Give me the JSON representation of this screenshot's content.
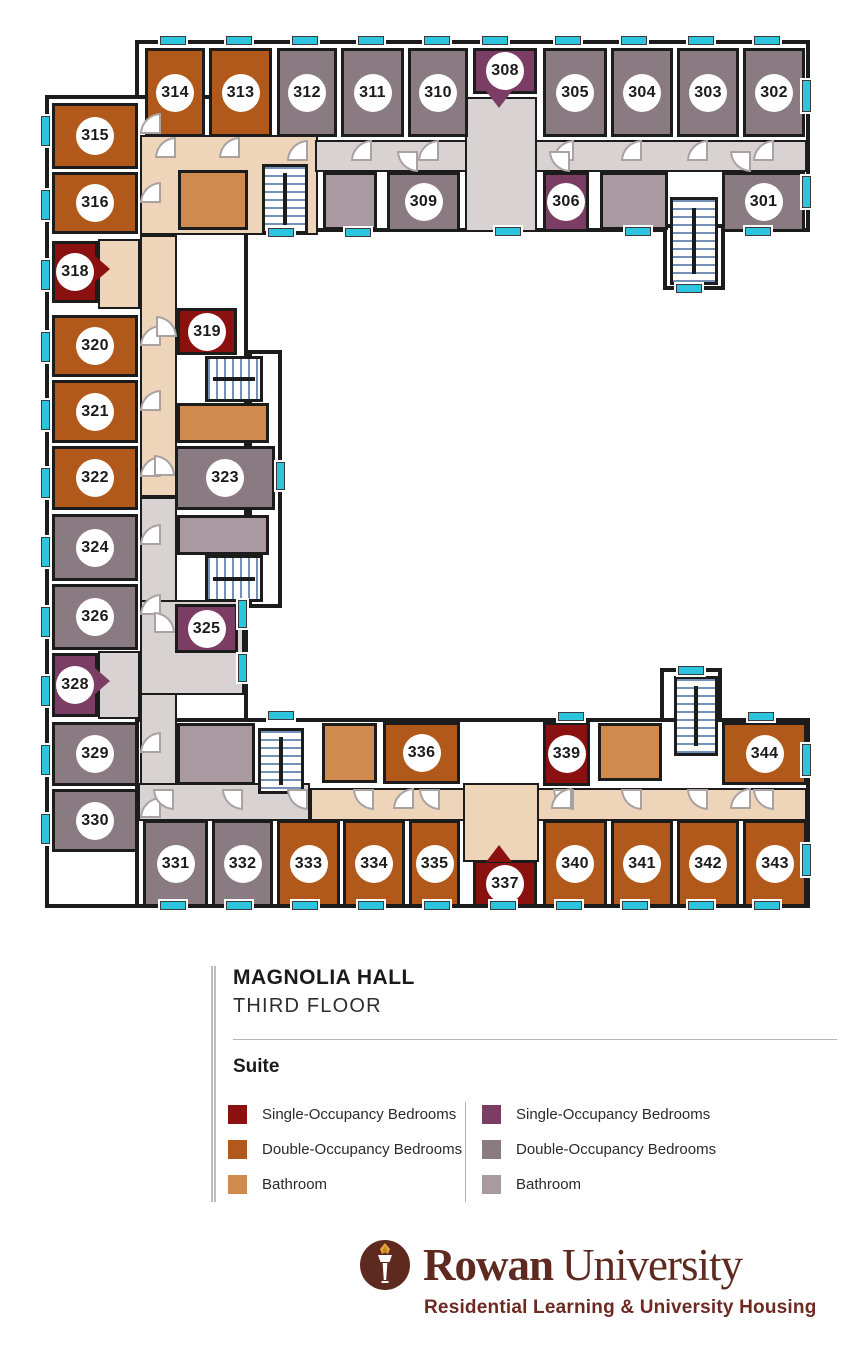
{
  "header": {
    "building": "MAGNOLIA HALL",
    "floor": "THIRD FLOOR"
  },
  "legend": {
    "heading": "Suite",
    "columns": [
      {
        "items": [
          {
            "swatch": "A.single",
            "label": "Single-Occupancy Bedrooms"
          },
          {
            "swatch": "A.double",
            "label": "Double-Occupancy Bedrooms"
          },
          {
            "swatch": "A.bath",
            "label": "Bathroom"
          }
        ]
      },
      {
        "items": [
          {
            "swatch": "B.single",
            "label": "Single-Occupancy Bedrooms"
          },
          {
            "swatch": "B.double",
            "label": "Double-Occupancy Bedrooms"
          },
          {
            "swatch": "B.bath",
            "label": "Bathroom"
          }
        ]
      }
    ]
  },
  "footer": {
    "brand_primary": "Rowan",
    "brand_secondary": "University",
    "tagline": "Residential Learning & University Housing"
  },
  "palette": {
    "suites": {
      "A": {
        "single": "#8b1010",
        "double": "#b1591a",
        "bath": "#d08a4e",
        "hall": "#eed5ba"
      },
      "B": {
        "single": "#7b3d64",
        "double": "#8a7a81",
        "bath": "#a89aa0",
        "hall": "#d8d3d2"
      }
    },
    "window": "#2cc4de",
    "wall": "#1c1c1c",
    "stair_tread": "#7492b8",
    "logo_brown": "#5e2a20",
    "tagline_brown": "#6e2a22",
    "flame_gold": "#e8a33c"
  },
  "floorplan": {
    "shell": [
      {
        "x": 135,
        "y": 40,
        "w": 675,
        "h": 192
      },
      {
        "x": 45,
        "y": 95,
        "w": 203,
        "h": 813
      },
      {
        "x": 248,
        "y": 350,
        "w": 34,
        "h": 258
      },
      {
        "x": 135,
        "y": 718,
        "w": 675,
        "h": 190
      },
      {
        "x": 663,
        "y": 224,
        "w": 62,
        "h": 66
      },
      {
        "x": 660,
        "y": 668,
        "w": 62,
        "h": 54
      }
    ],
    "corridors": [
      {
        "x": 140,
        "y": 135,
        "w": 178,
        "h": 100,
        "fill": "A.hall"
      },
      {
        "x": 140,
        "y": 235,
        "w": 37,
        "h": 262,
        "fill": "A.hall"
      },
      {
        "x": 98,
        "y": 239,
        "w": 42,
        "h": 70,
        "fill": "A.hall"
      },
      {
        "x": 310,
        "y": 788,
        "w": 497,
        "h": 33,
        "fill": "A.hall"
      },
      {
        "x": 463,
        "y": 783,
        "w": 76,
        "h": 79,
        "fill": "A.hall"
      },
      {
        "x": 315,
        "y": 140,
        "w": 492,
        "h": 32,
        "fill": "B.hall"
      },
      {
        "x": 465,
        "y": 97,
        "w": 72,
        "h": 135,
        "fill": "B.hall"
      },
      {
        "x": 140,
        "y": 497,
        "w": 37,
        "h": 291,
        "fill": "B.hall"
      },
      {
        "x": 98,
        "y": 651,
        "w": 42,
        "h": 68,
        "fill": "B.hall"
      },
      {
        "x": 140,
        "y": 600,
        "w": 104,
        "h": 95,
        "fill": "B.hall"
      },
      {
        "x": 138,
        "y": 783,
        "w": 172,
        "h": 38,
        "fill": "B.hall"
      }
    ],
    "baths": [
      {
        "x": 178,
        "y": 170,
        "w": 70,
        "h": 60,
        "fill": "A.bath"
      },
      {
        "x": 323,
        "y": 172,
        "w": 54,
        "h": 58,
        "fill": "B.bath"
      },
      {
        "x": 600,
        "y": 172,
        "w": 68,
        "h": 58,
        "fill": "B.bath"
      },
      {
        "x": 177,
        "y": 403,
        "w": 92,
        "h": 40,
        "fill": "A.bath"
      },
      {
        "x": 177,
        "y": 515,
        "w": 92,
        "h": 40,
        "fill": "B.bath"
      },
      {
        "x": 177,
        "y": 723,
        "w": 78,
        "h": 62,
        "fill": "B.bath"
      },
      {
        "x": 322,
        "y": 723,
        "w": 55,
        "h": 60,
        "fill": "A.bath"
      },
      {
        "x": 598,
        "y": 723,
        "w": 64,
        "h": 58,
        "fill": "A.bath"
      }
    ],
    "stairs": [
      {
        "x": 262,
        "y": 164,
        "w": 46,
        "h": 70,
        "dir": "v"
      },
      {
        "x": 670,
        "y": 197,
        "w": 48,
        "h": 88,
        "dir": "v"
      },
      {
        "x": 205,
        "y": 356,
        "w": 58,
        "h": 46,
        "dir": "h"
      },
      {
        "x": 205,
        "y": 555,
        "w": 58,
        "h": 47,
        "dir": "h"
      },
      {
        "x": 258,
        "y": 728,
        "w": 46,
        "h": 66,
        "dir": "v"
      },
      {
        "x": 674,
        "y": 676,
        "w": 44,
        "h": 80,
        "dir": "v"
      }
    ],
    "rooms": [
      {
        "num": "314",
        "x": 145,
        "y": 48,
        "w": 60,
        "h": 89,
        "fill": "A.double"
      },
      {
        "num": "313",
        "x": 209,
        "y": 48,
        "w": 63,
        "h": 89,
        "fill": "A.double"
      },
      {
        "num": "312",
        "x": 277,
        "y": 48,
        "w": 60,
        "h": 89,
        "fill": "B.double"
      },
      {
        "num": "311",
        "x": 341,
        "y": 48,
        "w": 63,
        "h": 89,
        "fill": "B.double"
      },
      {
        "num": "310",
        "x": 408,
        "y": 48,
        "w": 60,
        "h": 89,
        "fill": "B.double"
      },
      {
        "num": "308",
        "x": 473,
        "y": 48,
        "w": 64,
        "h": 46,
        "fill": "B.single"
      },
      {
        "num": "305",
        "x": 543,
        "y": 48,
        "w": 64,
        "h": 89,
        "fill": "B.double"
      },
      {
        "num": "304",
        "x": 611,
        "y": 48,
        "w": 62,
        "h": 89,
        "fill": "B.double"
      },
      {
        "num": "303",
        "x": 677,
        "y": 48,
        "w": 62,
        "h": 89,
        "fill": "B.double"
      },
      {
        "num": "302",
        "x": 743,
        "y": 48,
        "w": 62,
        "h": 89,
        "fill": "B.double"
      },
      {
        "num": "315",
        "x": 52,
        "y": 103,
        "w": 86,
        "h": 66,
        "fill": "A.double"
      },
      {
        "num": "316",
        "x": 52,
        "y": 172,
        "w": 86,
        "h": 62,
        "fill": "A.double"
      },
      {
        "num": "309",
        "x": 387,
        "y": 172,
        "w": 73,
        "h": 60,
        "fill": "B.double"
      },
      {
        "num": "306",
        "x": 543,
        "y": 172,
        "w": 46,
        "h": 60,
        "fill": "B.single"
      },
      {
        "num": "301",
        "x": 722,
        "y": 172,
        "w": 83,
        "h": 60,
        "fill": "B.double"
      },
      {
        "num": "318",
        "x": 52,
        "y": 241,
        "w": 46,
        "h": 62,
        "fill": "A.single"
      },
      {
        "num": "319",
        "x": 177,
        "y": 308,
        "w": 60,
        "h": 47,
        "fill": "A.single"
      },
      {
        "num": "320",
        "x": 52,
        "y": 315,
        "w": 86,
        "h": 62,
        "fill": "A.double"
      },
      {
        "num": "321",
        "x": 52,
        "y": 380,
        "w": 86,
        "h": 63,
        "fill": "A.double"
      },
      {
        "num": "322",
        "x": 52,
        "y": 446,
        "w": 86,
        "h": 64,
        "fill": "A.double"
      },
      {
        "num": "323",
        "x": 175,
        "y": 446,
        "w": 100,
        "h": 64,
        "fill": "B.double"
      },
      {
        "num": "324",
        "x": 52,
        "y": 514,
        "w": 86,
        "h": 67,
        "fill": "B.double"
      },
      {
        "num": "326",
        "x": 52,
        "y": 584,
        "w": 86,
        "h": 66,
        "fill": "B.double"
      },
      {
        "num": "325",
        "x": 175,
        "y": 604,
        "w": 63,
        "h": 49,
        "fill": "B.single"
      },
      {
        "num": "328",
        "x": 52,
        "y": 653,
        "w": 46,
        "h": 64,
        "fill": "B.single"
      },
      {
        "num": "329",
        "x": 52,
        "y": 722,
        "w": 86,
        "h": 64,
        "fill": "B.double"
      },
      {
        "num": "330",
        "x": 52,
        "y": 789,
        "w": 86,
        "h": 63,
        "fill": "B.double"
      },
      {
        "num": "336",
        "x": 383,
        "y": 722,
        "w": 77,
        "h": 62,
        "fill": "A.double"
      },
      {
        "num": "339",
        "x": 543,
        "y": 722,
        "w": 47,
        "h": 64,
        "fill": "A.single"
      },
      {
        "num": "344",
        "x": 722,
        "y": 722,
        "w": 85,
        "h": 63,
        "fill": "A.double"
      },
      {
        "num": "331",
        "x": 143,
        "y": 820,
        "w": 65,
        "h": 87,
        "fill": "B.double"
      },
      {
        "num": "332",
        "x": 212,
        "y": 820,
        "w": 61,
        "h": 87,
        "fill": "B.double"
      },
      {
        "num": "333",
        "x": 277,
        "y": 820,
        "w": 63,
        "h": 87,
        "fill": "A.double"
      },
      {
        "num": "334",
        "x": 343,
        "y": 820,
        "w": 62,
        "h": 87,
        "fill": "A.double"
      },
      {
        "num": "335",
        "x": 409,
        "y": 820,
        "w": 51,
        "h": 87,
        "fill": "A.double"
      },
      {
        "num": "337",
        "x": 473,
        "y": 860,
        "w": 64,
        "h": 47,
        "fill": "A.single"
      },
      {
        "num": "340",
        "x": 543,
        "y": 820,
        "w": 64,
        "h": 87,
        "fill": "A.double"
      },
      {
        "num": "341",
        "x": 611,
        "y": 820,
        "w": 62,
        "h": 87,
        "fill": "A.double"
      },
      {
        "num": "342",
        "x": 677,
        "y": 820,
        "w": 62,
        "h": 87,
        "fill": "A.double"
      },
      {
        "num": "343",
        "x": 743,
        "y": 820,
        "w": 64,
        "h": 87,
        "fill": "A.double"
      }
    ],
    "tails": [
      {
        "x": 486,
        "y": 91,
        "w": 26,
        "h": 17,
        "dir": "down",
        "fill": "B.single"
      },
      {
        "x": 95,
        "y": 256,
        "w": 15,
        "h": 26,
        "dir": "right",
        "fill": "A.single"
      },
      {
        "x": 95,
        "y": 668,
        "w": 15,
        "h": 26,
        "dir": "right",
        "fill": "B.single"
      },
      {
        "x": 486,
        "y": 845,
        "w": 26,
        "h": 17,
        "dir": "up",
        "fill": "A.single"
      }
    ],
    "doors": [
      {
        "x": 287,
        "y": 140,
        "q": "tl"
      },
      {
        "x": 351,
        "y": 140,
        "q": "tl"
      },
      {
        "x": 418,
        "y": 140,
        "q": "tl"
      },
      {
        "x": 553,
        "y": 140,
        "q": "tl"
      },
      {
        "x": 621,
        "y": 140,
        "q": "tl"
      },
      {
        "x": 687,
        "y": 140,
        "q": "tl"
      },
      {
        "x": 753,
        "y": 140,
        "q": "tl"
      },
      {
        "x": 155,
        "y": 137,
        "q": "tl"
      },
      {
        "x": 219,
        "y": 137,
        "q": "tl"
      },
      {
        "x": 397,
        "y": 151,
        "q": "bl"
      },
      {
        "x": 549,
        "y": 151,
        "q": "bl"
      },
      {
        "x": 730,
        "y": 151,
        "q": "bl"
      },
      {
        "x": 140,
        "y": 113,
        "q": "tl"
      },
      {
        "x": 140,
        "y": 182,
        "q": "tl"
      },
      {
        "x": 140,
        "y": 325,
        "q": "tl"
      },
      {
        "x": 140,
        "y": 390,
        "q": "tl"
      },
      {
        "x": 140,
        "y": 456,
        "q": "tl"
      },
      {
        "x": 140,
        "y": 524,
        "q": "tl"
      },
      {
        "x": 140,
        "y": 594,
        "q": "tl"
      },
      {
        "x": 140,
        "y": 732,
        "q": "tl"
      },
      {
        "x": 140,
        "y": 797,
        "q": "tl"
      },
      {
        "x": 156,
        "y": 316,
        "q": "tr"
      },
      {
        "x": 154,
        "y": 455,
        "q": "tr"
      },
      {
        "x": 154,
        "y": 612,
        "q": "tr"
      },
      {
        "x": 153,
        "y": 789,
        "q": "bl"
      },
      {
        "x": 222,
        "y": 789,
        "q": "bl"
      },
      {
        "x": 287,
        "y": 789,
        "q": "bl"
      },
      {
        "x": 353,
        "y": 789,
        "q": "bl"
      },
      {
        "x": 419,
        "y": 789,
        "q": "bl"
      },
      {
        "x": 553,
        "y": 789,
        "q": "bl"
      },
      {
        "x": 621,
        "y": 789,
        "q": "bl"
      },
      {
        "x": 687,
        "y": 789,
        "q": "bl"
      },
      {
        "x": 753,
        "y": 789,
        "q": "bl"
      },
      {
        "x": 393,
        "y": 788,
        "q": "tl"
      },
      {
        "x": 551,
        "y": 788,
        "q": "tl"
      },
      {
        "x": 730,
        "y": 788,
        "q": "tl"
      }
    ],
    "windows": [
      {
        "x": 160,
        "y": 36,
        "w": 26,
        "h": 9
      },
      {
        "x": 226,
        "y": 36,
        "w": 26,
        "h": 9
      },
      {
        "x": 292,
        "y": 36,
        "w": 26,
        "h": 9
      },
      {
        "x": 358,
        "y": 36,
        "w": 26,
        "h": 9
      },
      {
        "x": 424,
        "y": 36,
        "w": 26,
        "h": 9
      },
      {
        "x": 482,
        "y": 36,
        "w": 26,
        "h": 9
      },
      {
        "x": 555,
        "y": 36,
        "w": 26,
        "h": 9
      },
      {
        "x": 621,
        "y": 36,
        "w": 26,
        "h": 9
      },
      {
        "x": 688,
        "y": 36,
        "w": 26,
        "h": 9
      },
      {
        "x": 754,
        "y": 36,
        "w": 26,
        "h": 9
      },
      {
        "x": 160,
        "y": 901,
        "w": 26,
        "h": 9
      },
      {
        "x": 226,
        "y": 901,
        "w": 26,
        "h": 9
      },
      {
        "x": 292,
        "y": 901,
        "w": 26,
        "h": 9
      },
      {
        "x": 358,
        "y": 901,
        "w": 26,
        "h": 9
      },
      {
        "x": 424,
        "y": 901,
        "w": 26,
        "h": 9
      },
      {
        "x": 490,
        "y": 901,
        "w": 26,
        "h": 9
      },
      {
        "x": 556,
        "y": 901,
        "w": 26,
        "h": 9
      },
      {
        "x": 622,
        "y": 901,
        "w": 26,
        "h": 9
      },
      {
        "x": 688,
        "y": 901,
        "w": 26,
        "h": 9
      },
      {
        "x": 754,
        "y": 901,
        "w": 26,
        "h": 9
      },
      {
        "x": 41,
        "y": 116,
        "w": 9,
        "h": 30
      },
      {
        "x": 41,
        "y": 190,
        "w": 9,
        "h": 30
      },
      {
        "x": 41,
        "y": 260,
        "w": 9,
        "h": 30
      },
      {
        "x": 41,
        "y": 332,
        "w": 9,
        "h": 30
      },
      {
        "x": 41,
        "y": 400,
        "w": 9,
        "h": 30
      },
      {
        "x": 41,
        "y": 468,
        "w": 9,
        "h": 30
      },
      {
        "x": 41,
        "y": 537,
        "w": 9,
        "h": 30
      },
      {
        "x": 41,
        "y": 607,
        "w": 9,
        "h": 30
      },
      {
        "x": 41,
        "y": 676,
        "w": 9,
        "h": 30
      },
      {
        "x": 41,
        "y": 745,
        "w": 9,
        "h": 30
      },
      {
        "x": 41,
        "y": 814,
        "w": 9,
        "h": 30
      },
      {
        "x": 802,
        "y": 80,
        "w": 9,
        "h": 32
      },
      {
        "x": 802,
        "y": 176,
        "w": 9,
        "h": 32
      },
      {
        "x": 802,
        "y": 744,
        "w": 9,
        "h": 32
      },
      {
        "x": 802,
        "y": 844,
        "w": 9,
        "h": 32
      },
      {
        "x": 238,
        "y": 600,
        "w": 9,
        "h": 28
      },
      {
        "x": 238,
        "y": 654,
        "w": 9,
        "h": 28
      },
      {
        "x": 276,
        "y": 462,
        "w": 9,
        "h": 28
      },
      {
        "x": 676,
        "y": 284,
        "w": 26,
        "h": 9
      },
      {
        "x": 678,
        "y": 666,
        "w": 26,
        "h": 9
      },
      {
        "x": 268,
        "y": 228,
        "w": 26,
        "h": 9
      },
      {
        "x": 345,
        "y": 228,
        "w": 26,
        "h": 9
      },
      {
        "x": 495,
        "y": 227,
        "w": 26,
        "h": 9
      },
      {
        "x": 625,
        "y": 227,
        "w": 26,
        "h": 9
      },
      {
        "x": 745,
        "y": 227,
        "w": 26,
        "h": 9
      },
      {
        "x": 268,
        "y": 711,
        "w": 26,
        "h": 9
      },
      {
        "x": 558,
        "y": 712,
        "w": 26,
        "h": 9
      },
      {
        "x": 748,
        "y": 712,
        "w": 26,
        "h": 9
      }
    ]
  }
}
